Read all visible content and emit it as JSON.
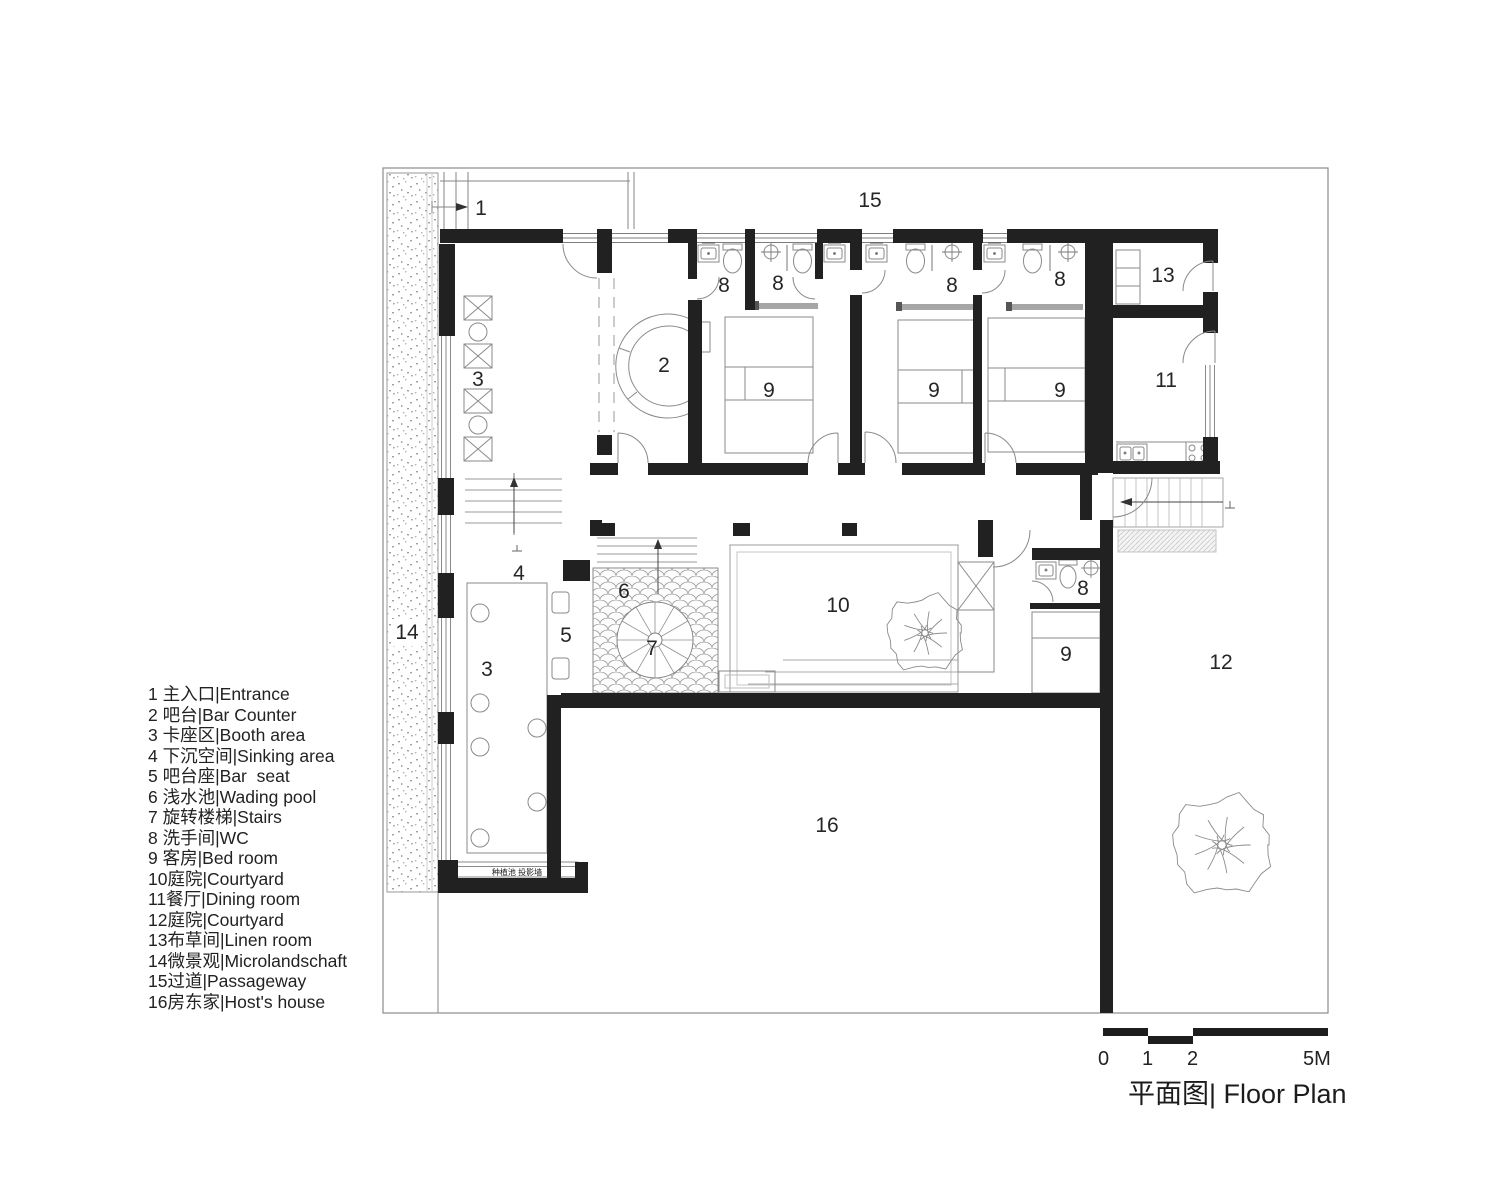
{
  "title": "平面图| Floor Plan",
  "legend": {
    "items": [
      "1 主入口|Entrance",
      "2 吧台|Bar Counter",
      "3 卡座区|Booth area",
      "4 下沉空间|Sinking area",
      "5 吧台座|Bar  seat",
      "6 浅水池|Wading pool",
      "7 旋转楼梯|Stairs",
      "8 洗手间|WC",
      "9 客房|Bed room",
      "10庭院|Courtyard",
      "11餐厅|Dining room",
      "12庭院|Courtyard",
      "13布草间|Linen room",
      "14微景观|Microlandschaft",
      "15过道|Passageway",
      "16房东家|Host's house"
    ]
  },
  "plan_labels": [
    {
      "text": "1",
      "x": 481,
      "y": 215
    },
    {
      "text": "15",
      "x": 870,
      "y": 207
    },
    {
      "text": "8",
      "x": 724,
      "y": 292
    },
    {
      "text": "8",
      "x": 778,
      "y": 290
    },
    {
      "text": "8",
      "x": 952,
      "y": 292
    },
    {
      "text": "8",
      "x": 1060,
      "y": 286
    },
    {
      "text": "8",
      "x": 1083,
      "y": 595
    },
    {
      "text": "13",
      "x": 1163,
      "y": 282
    },
    {
      "text": "2",
      "x": 664,
      "y": 372
    },
    {
      "text": "3",
      "x": 478,
      "y": 386
    },
    {
      "text": "3",
      "x": 487,
      "y": 676
    },
    {
      "text": "9",
      "x": 769,
      "y": 397
    },
    {
      "text": "9",
      "x": 934,
      "y": 397
    },
    {
      "text": "9",
      "x": 1060,
      "y": 397
    },
    {
      "text": "9",
      "x": 1066,
      "y": 661
    },
    {
      "text": "11",
      "x": 1166,
      "y": 387
    },
    {
      "text": "4",
      "x": 519,
      "y": 580
    },
    {
      "text": "5",
      "x": 566,
      "y": 642
    },
    {
      "text": "6",
      "x": 624,
      "y": 598
    },
    {
      "text": "7",
      "x": 652,
      "y": 655
    },
    {
      "text": "10",
      "x": 838,
      "y": 612
    },
    {
      "text": "12",
      "x": 1221,
      "y": 669
    },
    {
      "text": "14",
      "x": 407,
      "y": 639
    },
    {
      "text": "16",
      "x": 827,
      "y": 832
    }
  ],
  "annotations": {
    "planting_wall": "种植池 投影墙"
  },
  "scale_bar": {
    "ticks": [
      "0",
      "1",
      "2",
      "5M"
    ]
  },
  "colors": {
    "wall": "#212121",
    "line": "#777777"
  }
}
